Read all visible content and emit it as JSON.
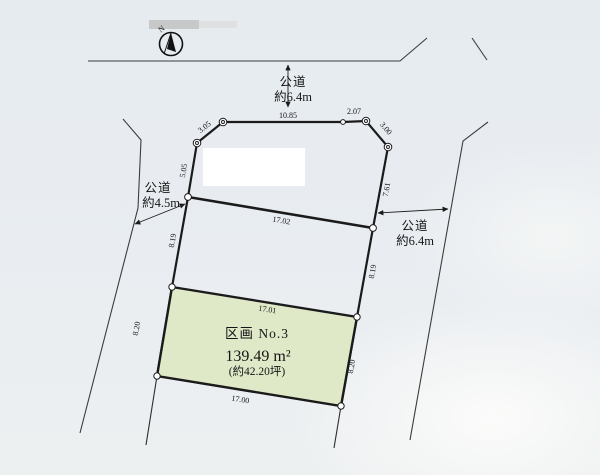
{
  "compass": {
    "label": "N"
  },
  "roads": {
    "north": {
      "name": "公道",
      "width": "約6.4m"
    },
    "west": {
      "name": "公道",
      "width": "約4.5m"
    },
    "east": {
      "name": "公道",
      "width": "約6.4m"
    }
  },
  "parcel": {
    "title": "区画 No.3",
    "area_sqm": "139.49 m²",
    "area_tsubo": "(約42.20坪)"
  },
  "dimensions": {
    "north_edge": "10.85",
    "north_edge_east": "2.07",
    "northwest_corner": "3.05",
    "northeast_corner": "3.00",
    "west_upper": "5.05",
    "east_upper": "7.61",
    "upper_section_south": "17.02",
    "middle_west": "8.19",
    "middle_east": "8.19",
    "parcel_north": "17.01",
    "parcel_west": "8.20",
    "parcel_east": "8.20",
    "parcel_south": "17.00"
  },
  "colors": {
    "parcel_fill": "#dfe9c8",
    "plot_interior": "#fafbf9",
    "background": "#e9edf2"
  }
}
